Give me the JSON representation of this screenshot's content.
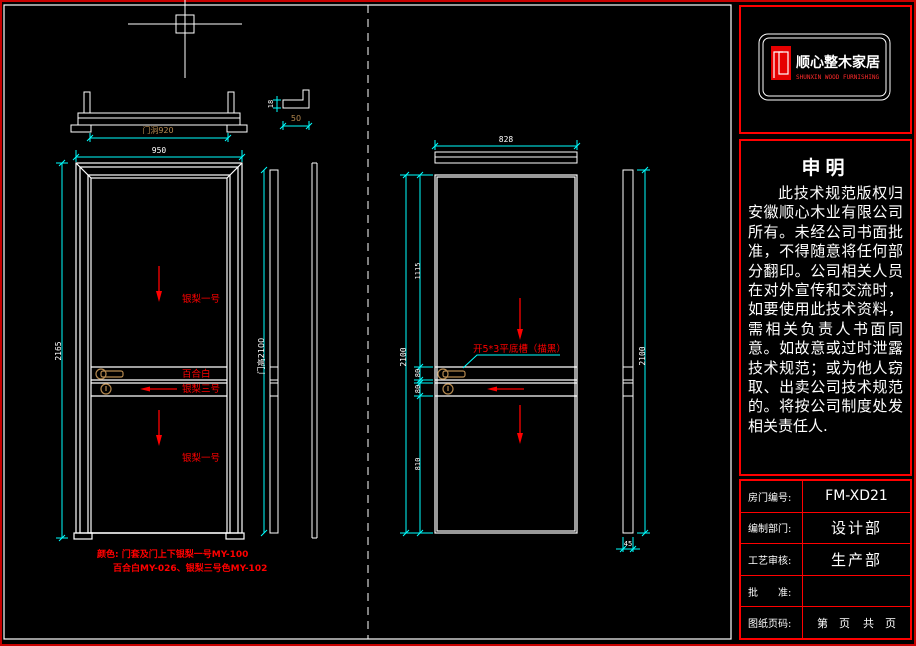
{
  "colors": {
    "line": "#ffffff",
    "dim_line": "#00ffff",
    "accent_red": "#ff0000",
    "hardware_tan": "#b5894f",
    "background": "#000000",
    "border_red": "#c80000"
  },
  "logo": {
    "brand_cn": "顺心整木家居",
    "brand_en": "SHUNXIN WOOD FURNISHING"
  },
  "declaration": {
    "title": "申明",
    "body": "此技术规范版权归安徽顺心木业有限公司所有。未经公司书面批准，不得随意将任何部分翻印。公司相关人员在对外宣传和交流时，如要使用此技术资料，需相关负责人书面同意。如故意或过时泄露技术规范；或为他人窃取、出卖公司技术规范的。将按公司制度处发相关责任人."
  },
  "title_table": {
    "rows": [
      {
        "label": "房门编号:",
        "value": "FM-XD21"
      },
      {
        "label": "编制部门:",
        "value": "设计部"
      },
      {
        "label": "工艺审核:",
        "value": "生产部"
      },
      {
        "label": "批　　准:",
        "value": ""
      },
      {
        "label": "图纸页码:",
        "value": ""
      }
    ],
    "page_left": "第　页",
    "page_right": "共　页"
  },
  "front_view": {
    "dim_hole_width": "门洞920",
    "dim_width": "950",
    "dim_height": "2165",
    "dim_door_height": "门高2100",
    "dim_profile_thickness": "18",
    "dim_profile_width": "50",
    "label_top_panel": "银梨一号",
    "label_lock_rail": "百合白",
    "label_mid_rail": "银梨三号",
    "label_bottom_panel": "银梨一号",
    "note_line1": "颜色: 门套及门上下银梨一号MY-100",
    "note_line2": "百合白MY-026、银梨三号色MY-102"
  },
  "back_view": {
    "dim_width": "828",
    "dim_top_panel": "1115",
    "dim_rail1": "80",
    "dim_rail2": "80",
    "dim_bottom_panel": "810",
    "dim_height": "2100",
    "dim_side_height": "2100",
    "dim_thickness": "45",
    "groove_note": "开5*3平底槽（描黑）"
  }
}
